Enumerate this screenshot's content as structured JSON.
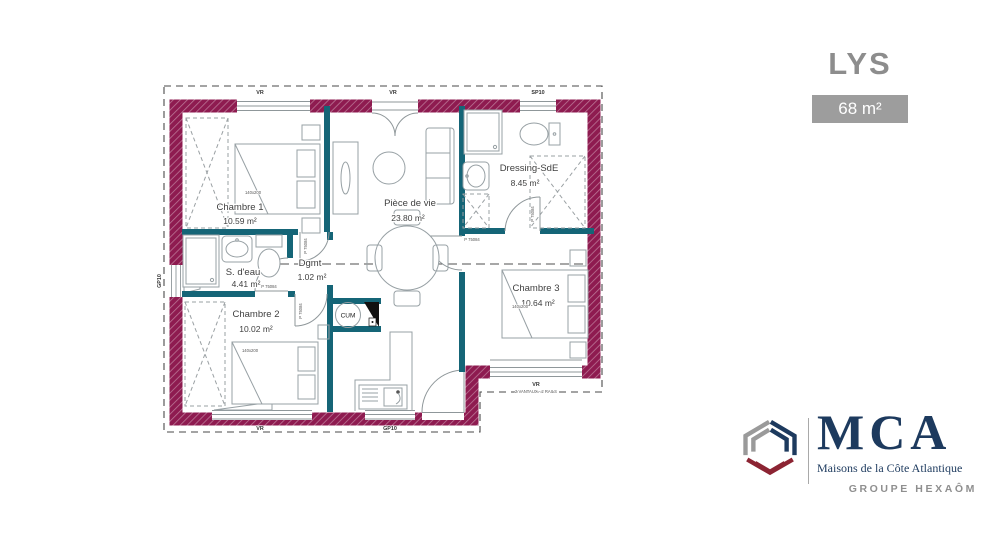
{
  "header": {
    "plan_name": "LYS",
    "area_badge": "68 m²"
  },
  "floorplan": {
    "rooms": {
      "chambre1": {
        "name": "Chambre 1",
        "area": "10.59 m²"
      },
      "piece_de_vie": {
        "name": "Pièce de vie",
        "area": "23.80 m²"
      },
      "dressing_sde": {
        "name": "Dressing-SdE",
        "area": "8.45 m²"
      },
      "s_deau": {
        "name": "S. d'eau",
        "area": "4.41 m²"
      },
      "dgmt": {
        "name": "Dgmt",
        "area": "1.02 m²"
      },
      "chambre2": {
        "name": "Chambre 2",
        "area": "10.02 m²"
      },
      "chambre3": {
        "name": "Chambre 3",
        "area": "10.64 m²"
      }
    },
    "annotations": {
      "roller_shutter": "VR",
      "sp10": "SP10",
      "gp10": "GP10",
      "door_ref": "P 75084",
      "bed_size": "140x200",
      "water_heater": "CUM",
      "bay_window_note": "2 VANTAUX - 2 RAILS"
    },
    "colors": {
      "exterior_wall": "#8e1b50",
      "interior_wall": "#156577",
      "furniture": "#97a0a4"
    }
  },
  "branding": {
    "name": "MCA",
    "tagline": "Maisons de la Côte Atlantique",
    "group": "GROUPE HEXAÔM",
    "colors": {
      "navy": "#1d3a5e",
      "gray": "#9a9a9a",
      "red": "#8c2433"
    }
  }
}
